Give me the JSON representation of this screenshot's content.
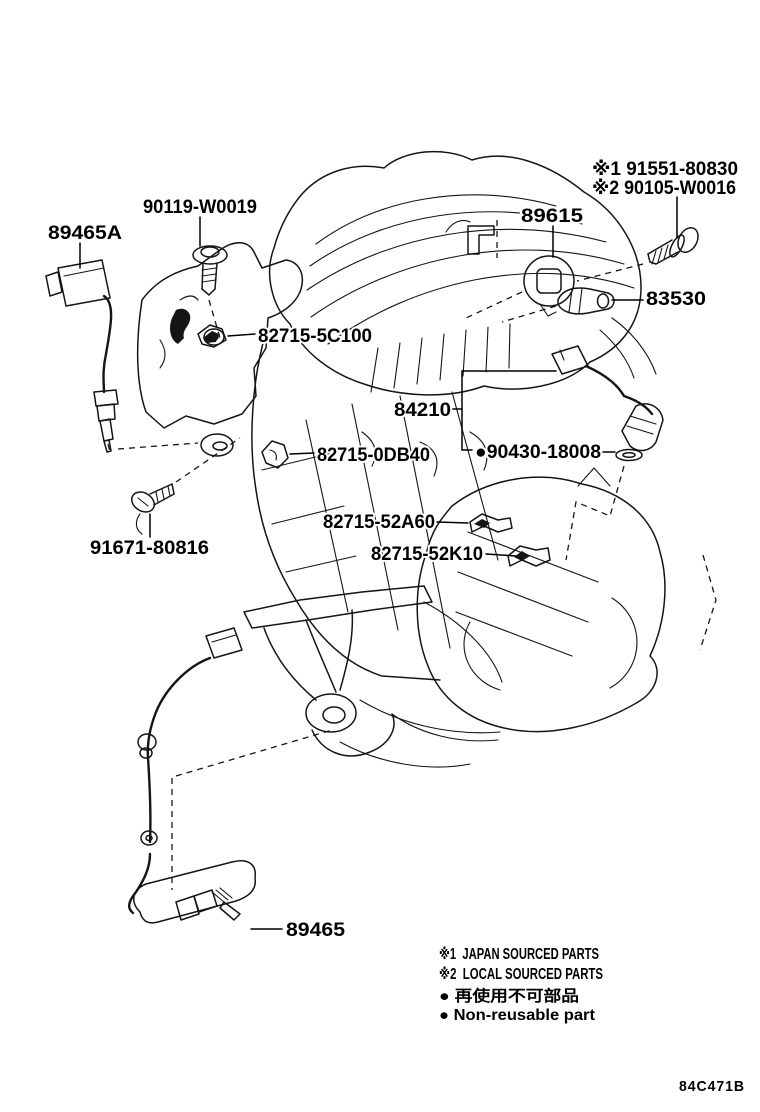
{
  "part_labels": {
    "ref_91551": "※1 91551-80830",
    "ref_90105": "※2 90105-W0016",
    "knock_sensor": "89615",
    "bolt_90119": "90119-W0019",
    "oxygen_sensor_a": "89465A",
    "oil_pressure_switch": "83530",
    "clamp_5c100": "82715-5C100",
    "cam_sensor": "84210",
    "gasket_90430": "●90430-18008",
    "clamp_0db40": "82715-0DB40",
    "clamp_52a60": "82715-52A60",
    "clamp_52k10": "82715-52K10",
    "bolt_91671": "91671-80816",
    "oxygen_sensor_b": "89465"
  },
  "legend": {
    "line1": "※1  JAPAN SOURCED PARTS",
    "line2": "※2  LOCAL SOURCED PARTS",
    "line3": "● 再使用不可部品",
    "line4": "● Non-reusable part"
  },
  "figure_code": "84C471B"
}
